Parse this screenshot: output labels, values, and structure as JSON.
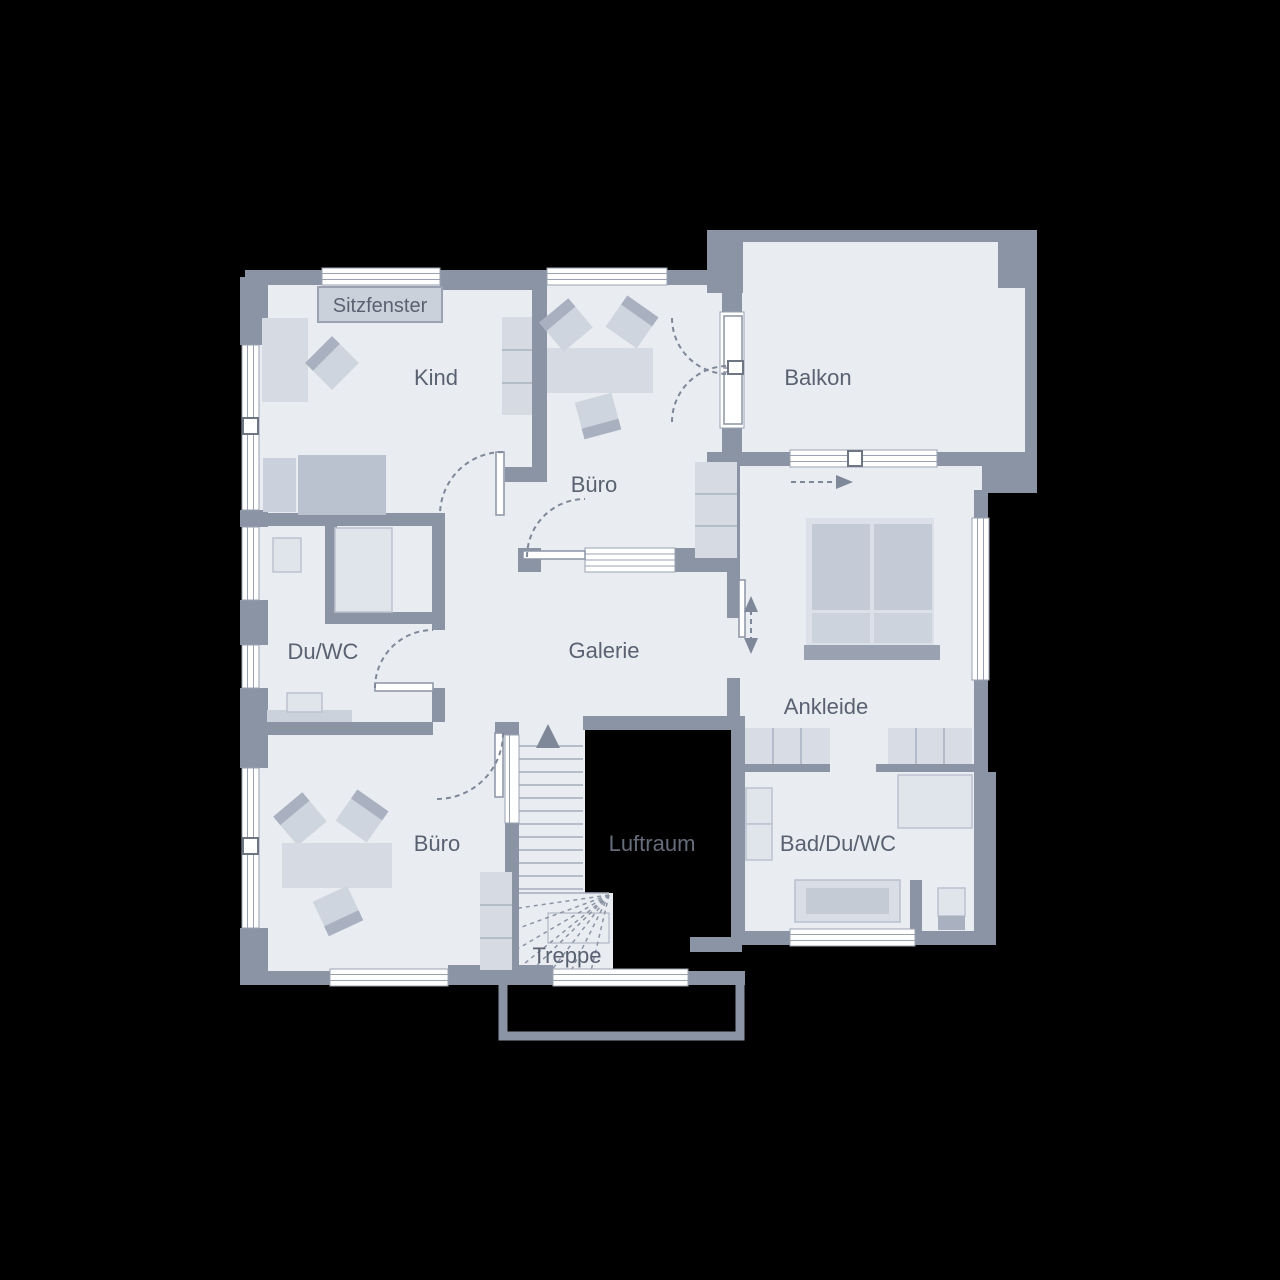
{
  "figure": {
    "type": "floor-plan",
    "style": "architectural upper-floor plan on black background",
    "background": "#000000"
  },
  "colors": {
    "wall": "#8B94A4",
    "floor": "#E9ECF1",
    "window": "#FFFFFF",
    "furniture": "#D6DBE3",
    "furniture_dark": "#A9B1C0",
    "fixture": "#E0E4EB",
    "void": "#000000",
    "label": "#5A6272",
    "void_label": "#666D7A"
  },
  "labels": {
    "sitzfenster": "Sitzfenster",
    "kind": "Kind",
    "buero_top": "Büro",
    "balkon": "Balkon",
    "du_wc": "Du/WC",
    "galerie": "Galerie",
    "ankleide": "Ankleide",
    "buero_bottom": "Büro",
    "luftraum": "Luftraum",
    "bad_du_wc": "Bad/Du/WC",
    "treppe": "Treppe"
  }
}
